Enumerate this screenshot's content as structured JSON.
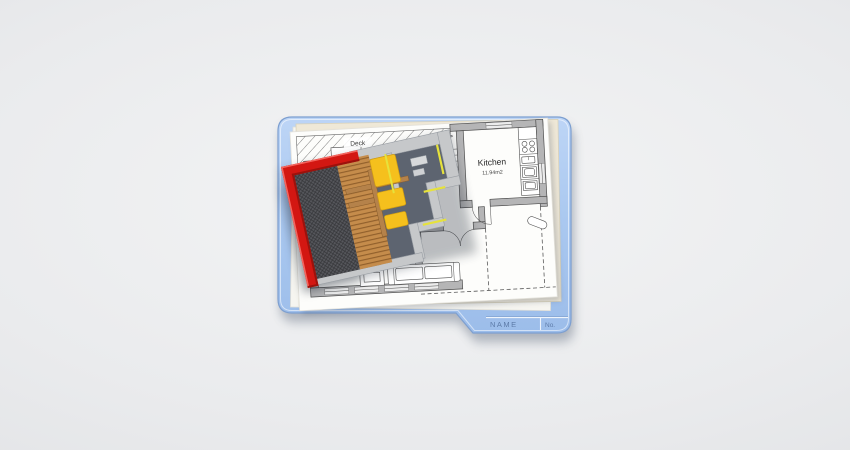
{
  "folder_tab": {
    "name_label": "NAME",
    "number_label": "No."
  },
  "floor_plan": {
    "deck_label": "Deck",
    "kitchen_label": "Kitchen",
    "kitchen_area_label": "11.94m2",
    "stairs_label": "UP"
  },
  "colors": {
    "background_center": "#f3f4f5",
    "background_edge": "#dcdee1",
    "folder_blue_light": "#bdd5f6",
    "folder_blue": "#abc9f0",
    "folder_blue_deep": "#9cbdea",
    "folder_border": "#7d9fd0",
    "folder_text": "#5d7ba8",
    "paper_white": "#fdfdfb",
    "paper_under": "#f6f5f0",
    "paper_cream": "#efe8d7",
    "paper_cream_edge": "#d9d1b8",
    "wall_gray": "#b5b5b6",
    "plan_line": "#4e4e4e",
    "window_fill": "#ececec",
    "roof_red": "#d31712",
    "roof_red_dark": "#9c120c",
    "roof_red_light": "#f4655e",
    "roof_hatch": "#56575c",
    "deck_wood": "#c58c4b",
    "deck_wood_line": "#8a5e2d",
    "beam_brown": "#b5824a",
    "furniture_yellow": "#f5c01d",
    "furniture_yellow_edge": "#cf9c12",
    "floor_3d": "#5d6470",
    "wall_3d": "#c6c8ca",
    "wall_3d_rim": "#989da3",
    "accent_yellow": "#e6e23c"
  }
}
